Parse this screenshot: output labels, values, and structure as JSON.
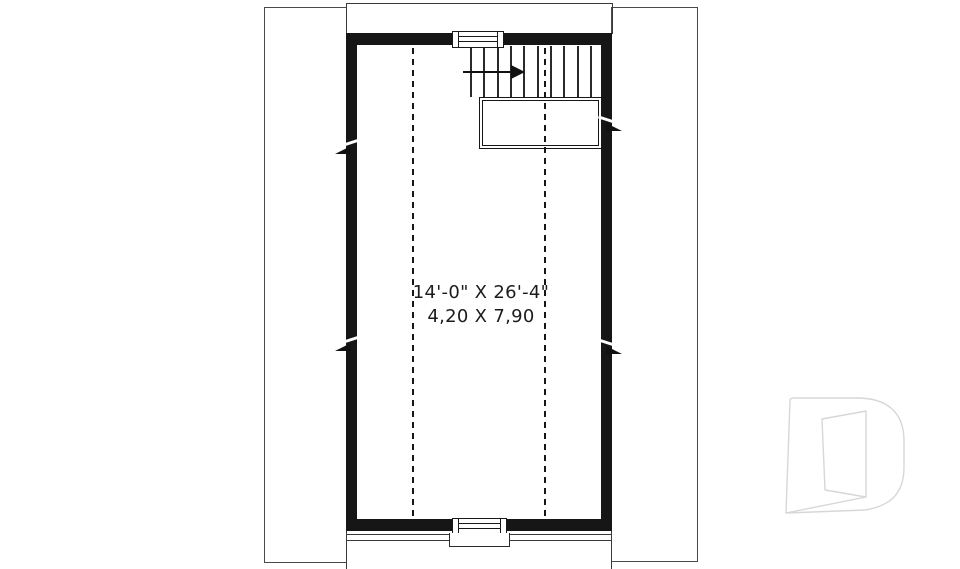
{
  "room": {
    "dimensions_imperial": "14'-0\" X 26'-4\"",
    "dimensions_metric": "4,20 X 7,90"
  },
  "colors": {
    "wall": "#161616",
    "thin_line": "#3a3a3a",
    "background": "#ffffff",
    "logo_outline": "#d7d7d7"
  },
  "icons": {
    "stairs_direction": "arrow-right",
    "watermark": "drummond-d-outline"
  }
}
